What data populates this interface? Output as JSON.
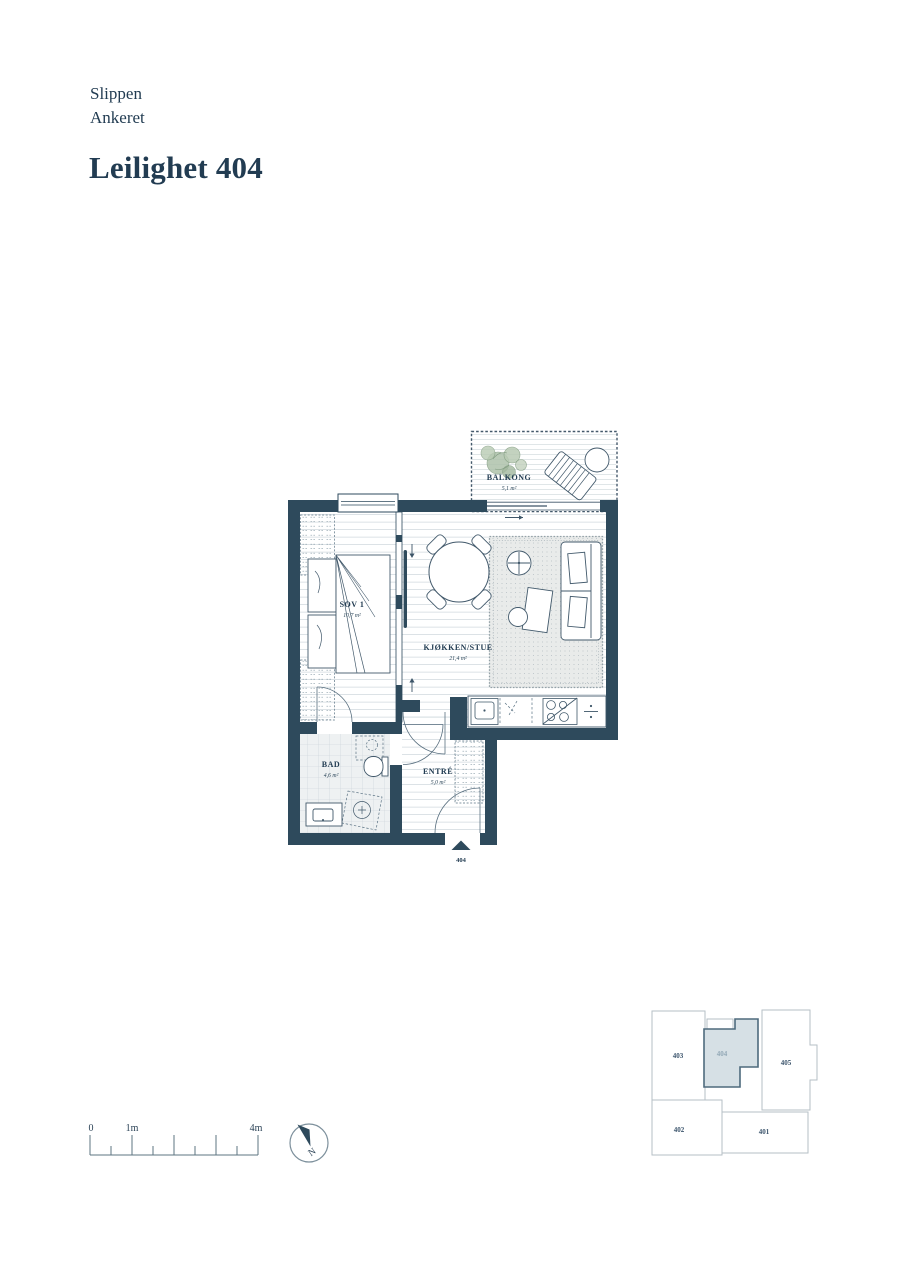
{
  "header": {
    "project": "Slippen",
    "building": "Ankeret",
    "title": "Leilighet 404"
  },
  "rooms": {
    "balcony": {
      "name": "BALKONG",
      "area": "5,1 m²"
    },
    "bedroom": {
      "name": "SOV 1",
      "area": "10,7 m²"
    },
    "living": {
      "name": "KJØKKEN/STUE",
      "area": "21,4 m²"
    },
    "bath": {
      "name": "BAD",
      "area": "4,6 m²"
    },
    "entry": {
      "name": "ENTRÉ",
      "area": "5,0 m²"
    }
  },
  "entrance": {
    "unit": "404"
  },
  "keyplan": {
    "highlighted": "404",
    "units": [
      {
        "id": "403"
      },
      {
        "id": "404"
      },
      {
        "id": "405"
      },
      {
        "id": "402"
      },
      {
        "id": "401"
      }
    ]
  },
  "scalebar": {
    "start": "0",
    "mid": "1m",
    "end": "4m"
  },
  "compass": {
    "north": "N"
  },
  "colors": {
    "wall": "#2e4a5c",
    "text": "#223c52",
    "keyplan_highlight": "#d6e0e5",
    "plant_green": "#a7bca2",
    "floor_line": "#c9d3d9"
  }
}
